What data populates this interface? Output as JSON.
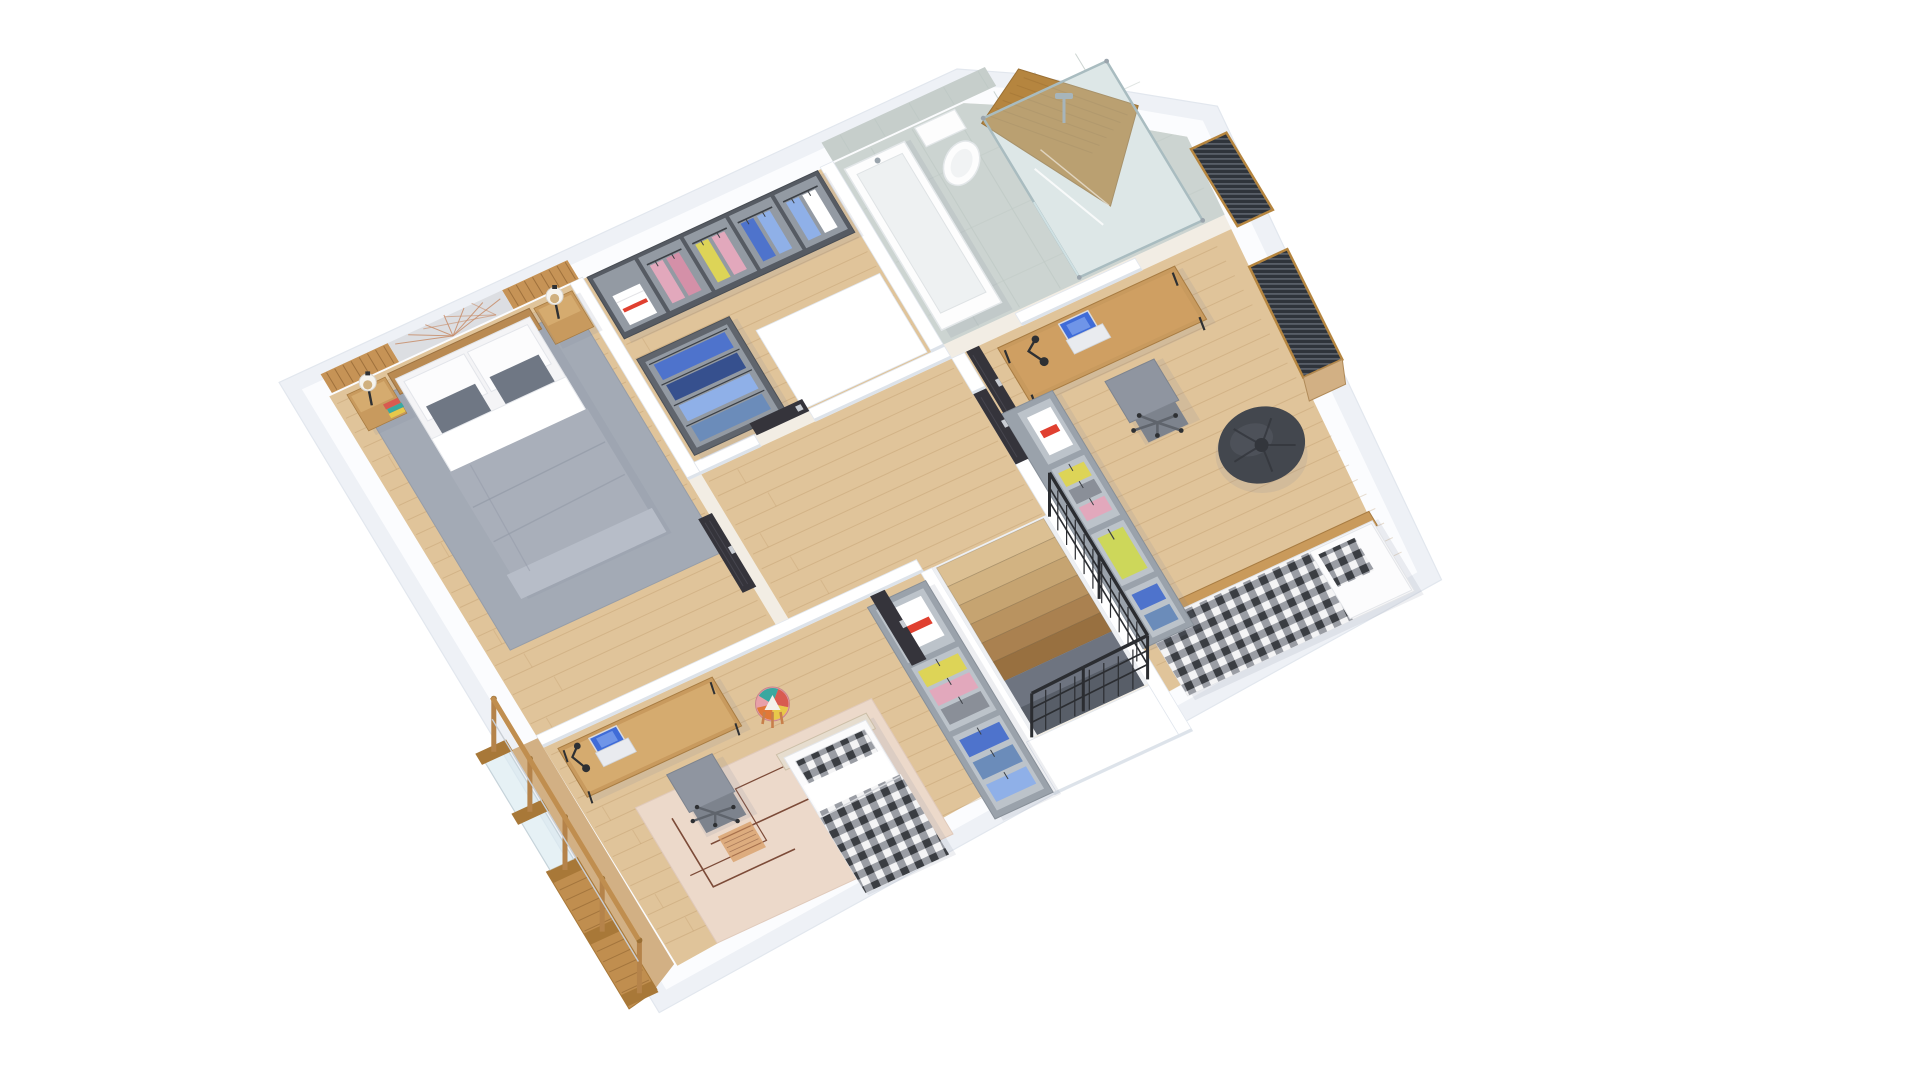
{
  "scene": {
    "kind": "isometric-floor-plan-render",
    "background": "#ffffff",
    "rooms": [
      {
        "id": "master-bedroom",
        "name": "Master bedroom",
        "floor": "wood",
        "furniture": [
          {
            "id": "accent-wall",
            "name": "wood slat accent wall with copper string art"
          },
          {
            "id": "area-rug",
            "name": "gray area rug"
          },
          {
            "id": "double-bed",
            "name": "double bed with gray duvet and white pillows"
          },
          {
            "id": "nightstand-left",
            "name": "wood nightstand"
          },
          {
            "id": "nightstand-right",
            "name": "wood nightstand"
          },
          {
            "id": "table-lamp-left",
            "name": "ball table lamp"
          },
          {
            "id": "table-lamp-right",
            "name": "ball table lamp"
          },
          {
            "id": "books",
            "name": "stacked books"
          },
          {
            "id": "door-master",
            "name": "dark interior door"
          }
        ]
      },
      {
        "id": "walk-in-closet",
        "name": "Walk-in closet",
        "floor": "wood",
        "furniture": [
          {
            "id": "wardrobe-top",
            "name": "dark gray open wardrobe with clothes"
          },
          {
            "id": "wardrobe-side",
            "name": "dark gray open wardrobe with blue clothes"
          },
          {
            "id": "storage-wall",
            "name": "white storage block"
          },
          {
            "id": "door-closet",
            "name": "dark interior door"
          }
        ]
      },
      {
        "id": "bathroom",
        "name": "Bathroom",
        "floor": "stone-tile",
        "furniture": [
          {
            "id": "bathtub",
            "name": "white bathtub"
          },
          {
            "id": "toilet",
            "name": "toilet"
          },
          {
            "id": "shower",
            "name": "glass shower with wood sloped wall"
          },
          {
            "id": "door-bath",
            "name": "dark interior door"
          }
        ]
      },
      {
        "id": "hallway",
        "name": "Hallway landing",
        "floor": "wood",
        "furniture": []
      },
      {
        "id": "kids-bedroom",
        "name": "Kids bedroom",
        "floor": "wood",
        "furniture": [
          {
            "id": "desk-kids",
            "name": "wood desk"
          },
          {
            "id": "laptop-kids",
            "name": "open laptop"
          },
          {
            "id": "desk-lamp-kids",
            "name": "black desk lamp"
          },
          {
            "id": "office-chair-kids",
            "name": "gray office chair"
          },
          {
            "id": "patchwork-stool",
            "name": "patchwork round stool"
          },
          {
            "id": "kids-rug",
            "name": "beige rug with geometric lines"
          },
          {
            "id": "single-bed-kids",
            "name": "single bed with black gingham blanket"
          },
          {
            "id": "wardrobe-kids",
            "name": "light gray open wardrobe"
          },
          {
            "id": "door-kids",
            "name": "dark interior door"
          }
        ]
      },
      {
        "id": "teen-bedroom",
        "name": "Teen bedroom",
        "floor": "wood",
        "furniture": [
          {
            "id": "desk-teen",
            "name": "wood desk"
          },
          {
            "id": "laptop-teen",
            "name": "open laptop"
          },
          {
            "id": "desk-lamp-teen",
            "name": "black desk lamp"
          },
          {
            "id": "office-chair-teen",
            "name": "gray office chair"
          },
          {
            "id": "bean-bag",
            "name": "dark bean bag"
          },
          {
            "id": "single-bed-teen",
            "name": "bed with gingham blanket"
          },
          {
            "id": "wardrobe-teen",
            "name": "light gray open wardrobe"
          },
          {
            "id": "window-small",
            "name": "window with dark venetian blinds"
          },
          {
            "id": "window-large",
            "name": "window with dark venetian blinds"
          },
          {
            "id": "door-teen",
            "name": "dark interior door"
          }
        ]
      },
      {
        "id": "staircase",
        "name": "Staircase",
        "floor": "wood-steps",
        "furniture": [
          {
            "id": "stair-steps",
            "name": "descending wood steps"
          },
          {
            "id": "metal-railing",
            "name": "black metal railing"
          }
        ]
      },
      {
        "id": "balcony",
        "name": "Stair-side balustrade",
        "floor": "wood",
        "furniture": [
          {
            "id": "wood-railing",
            "name": "oak and glass balustrade"
          },
          {
            "id": "walkway",
            "name": "wood walkway strip"
          }
        ]
      }
    ]
  },
  "palette": {
    "wallSide": "#eef1f6",
    "wallTop": "#fbfcfe",
    "wallEdge": "#e2e7ee",
    "innerWall": "#ffffff",
    "wallShadow": "#dde3ea",
    "floorWood": "#e0c49a",
    "plank": "#b98f5a",
    "floorWoodDark": "#d2b084",
    "tile": "#ccd4d1",
    "tileJoint": "#bfc9c6",
    "tileWall": "#c6cecb",
    "rugGray": "#a3aab5",
    "rugBeige": "#ecd9ca",
    "rugLine": "#7c4b38",
    "rugAccent": "#d9a06a",
    "woodFurn": "#c89a5e",
    "woodFurnLight": "#d5ab6f",
    "woodDark": "#a87c42",
    "slatWood": "#c69356",
    "artPanel": "#dcdee2",
    "copper": "#c88d6a",
    "duvet": "#a9afba",
    "duvetLight": "#b7bdc8",
    "duvetFold": "#939aa7",
    "white": "#fafafa",
    "cushion": "#6f7784",
    "darkWardrobe": "#565b63",
    "darkWardrobeIn": "#939aa3",
    "shelf": "#aab1b9",
    "lightWardrobe": "#9aa2ab",
    "lightWardrobeIn": "#bcc3ca",
    "clothes": {
      "blue": "#4e73cc",
      "lightblue": "#8fb0e8",
      "denim": "#6b8cba",
      "pink": "#e2a8bc",
      "rose": "#d490a8",
      "yellow": "#ddd457",
      "yellowgreen": "#cdd75a",
      "whiteItem": "#ffffff",
      "grayItem": "#8a8f98"
    },
    "door": "#35343b",
    "doorLine": "#46454e",
    "handle": "#c9cdd3",
    "railWood": "#c08e4f",
    "railWoodDark": "#a87838",
    "glass": "rgba(213,231,238,0.6)",
    "railBlack": "#2b2d31",
    "chair": "#8f95a0",
    "chairDark": "#7d838d",
    "chairBase": "#5f646c",
    "beanBag": "#43474e",
    "beanBagCrease": "#33363c",
    "beanBagHi": "#575c64",
    "screenBlue": "#3f6cd8",
    "laptopBody": "#e9ebef",
    "lampBlack": "#2e3033",
    "lampAmber": "#c9a36a",
    "fixtureWhite": "#fdfdfd",
    "fixtureShade": "#e3e7e9",
    "showerWood": "#b5853f",
    "showerWoodGrain": "#9c6f33",
    "showerGlass": "rgba(195,218,220,0.32)",
    "showerFrame": "#a9bcc0",
    "chrome": "#9aa4ac",
    "blinds": "#2f343b",
    "blindSlat": "#737a84",
    "stepShades": [
      "#dcc093",
      "#d2b382",
      "#c6a471",
      "#b99360",
      "#aa8150",
      "#987040"
    ],
    "voidDark": "#6e7480",
    "shadow": "rgba(125,135,155,0.14)"
  }
}
